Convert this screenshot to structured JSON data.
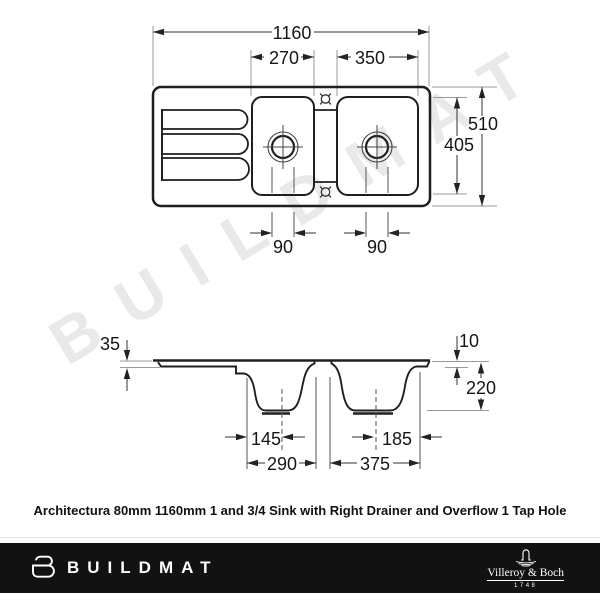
{
  "watermark": "BUILDMAT",
  "caption": "Architectura 80mm 1160mm 1 and 3/4 Sink with Right Drainer and Overflow 1 Tap Hole",
  "diagram": {
    "top_view": {
      "overall_width": "1160",
      "middle_bowl_width": "270",
      "right_bowl_width": "350",
      "overall_depth": "510",
      "bowl_depth": "405",
      "middle_drain_diameter": "90",
      "right_drain_diameter": "90"
    },
    "side_view": {
      "rim_thickness": "35",
      "edge_height": "10",
      "bowl_depth": "220",
      "middle_drain_offset": "145",
      "right_drain_offset": "185",
      "middle_bowl_width": "290",
      "right_bowl_width": "375"
    }
  },
  "footer": {
    "brand": "BUILDMAT",
    "manufacturer": "Villeroy & Boch",
    "established": "1748"
  },
  "colors": {
    "outline": "#1f1f1f",
    "dimension_line": "#333333",
    "extension_line": "#999999",
    "watermark": "#e9e9e9",
    "footer_background": "#121212",
    "footer_text": "#ffffff"
  }
}
